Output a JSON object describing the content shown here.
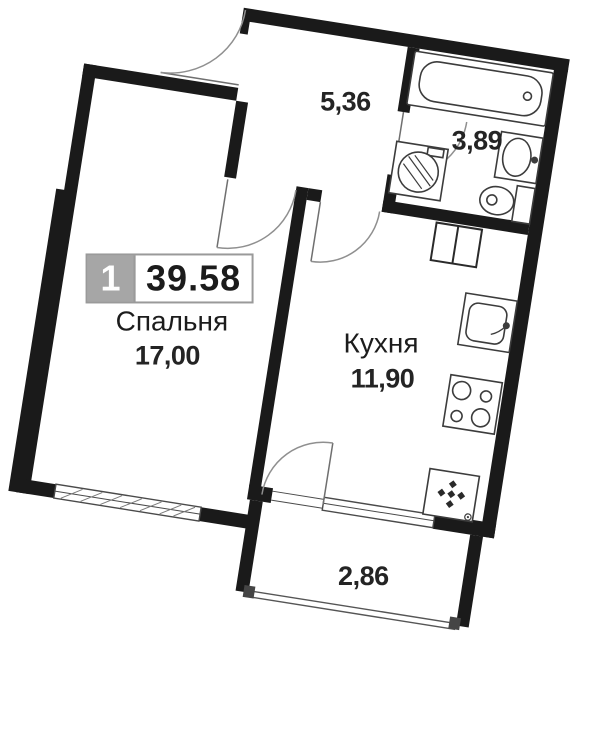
{
  "plan": {
    "unit_label": {
      "number": "1",
      "total_area": "39.58"
    },
    "rooms": [
      {
        "id": "bedroom",
        "name": "Спальня",
        "area": "17,00"
      },
      {
        "id": "hallway",
        "name": "",
        "area": "5,36"
      },
      {
        "id": "bathroom",
        "name": "",
        "area": "3,89"
      },
      {
        "id": "kitchen",
        "name": "Кухня",
        "area": "11,90"
      },
      {
        "id": "balcony",
        "name": "",
        "area": "2,86"
      }
    ],
    "fixtures": [
      "bathtub",
      "bath-sink",
      "toilet",
      "washing-machine",
      "vent-duct",
      "kitchen-sink",
      "stove",
      "refrigerator"
    ],
    "colors": {
      "wall": "#1a1a1a",
      "fixture_line": "#3c3c3c",
      "door_arc": "#8f8f8f",
      "label_box_gray": "#a6a6a6",
      "text": "#1f1f1f"
    }
  }
}
